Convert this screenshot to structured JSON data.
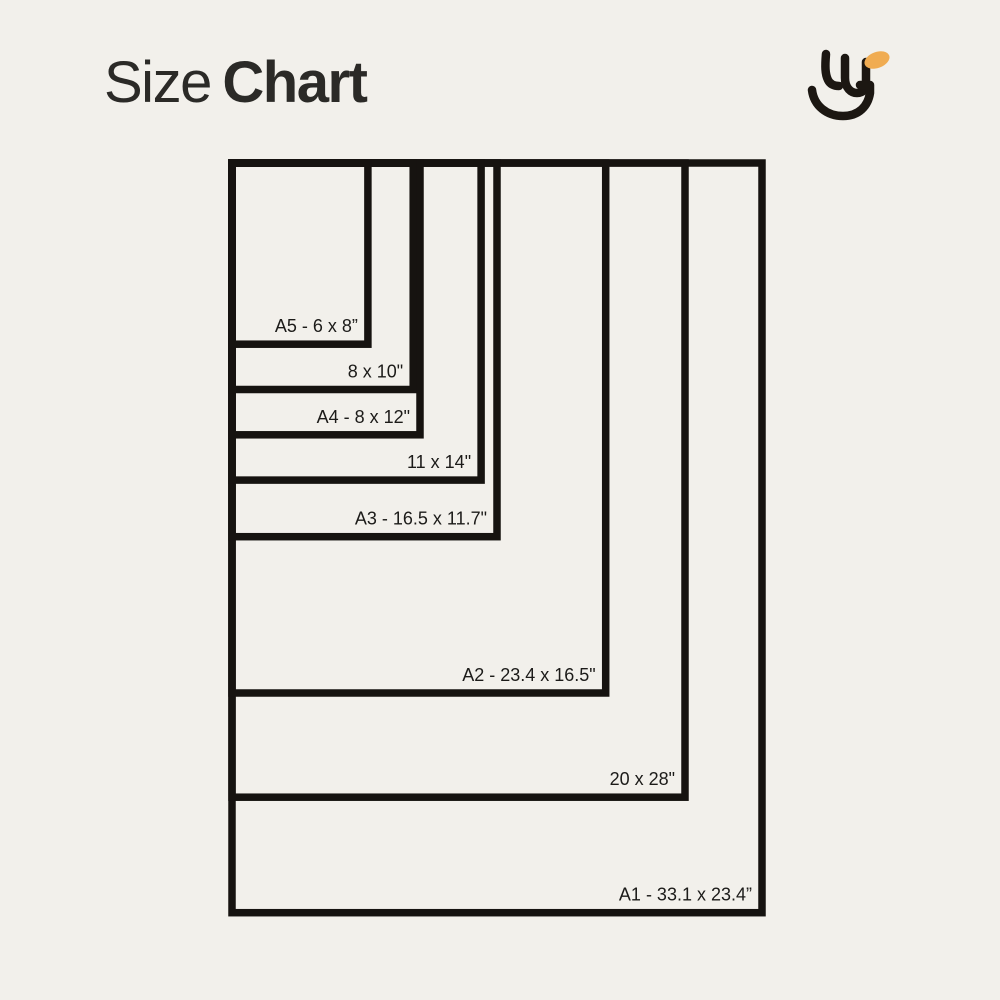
{
  "header": {
    "title_regular": "Size",
    "title_bold": "Chart"
  },
  "logo": {
    "description": "abstract-smile-monogram",
    "ink_color": "#1C1712",
    "accent_color": "#F0AC52"
  },
  "colors": {
    "background": "#F2F0EB",
    "frame": "#161310",
    "label_text": "#1C1B19",
    "title_text": "#2B2A27"
  },
  "chart_data": {
    "type": "nested_rectangles",
    "title": "Size Chart",
    "unit": "inches",
    "orientation": "portrait, all rectangles share top-left corner",
    "scale_px_per_inch": 22.65,
    "origin_px": {
      "x": 232,
      "y": 163
    },
    "frame_stroke_px": 7.5,
    "label_font_px": 18,
    "sizes": [
      {
        "name": "A5",
        "label": "A5 - 6 x 8”",
        "width_in": 6,
        "height_in": 8
      },
      {
        "name": "8x10",
        "label": "8 x 10\"",
        "width_in": 8,
        "height_in": 10
      },
      {
        "name": "A4",
        "label": "A4 - 8 x 12\"",
        "width_in": 8.3,
        "height_in": 12
      },
      {
        "name": "11x14",
        "label": "11 x 14\"",
        "width_in": 11,
        "height_in": 14
      },
      {
        "name": "A3",
        "label": "A3 - 16.5 x 11.7\"",
        "width_in": 11.7,
        "height_in": 16.5
      },
      {
        "name": "A2",
        "label": "A2 - 23.4 x 16.5\"",
        "width_in": 16.5,
        "height_in": 23.4
      },
      {
        "name": "20x28",
        "label": "20 x 28\"",
        "width_in": 20,
        "height_in": 28
      },
      {
        "name": "A1",
        "label": "A1 - 33.1 x 23.4”",
        "width_in": 23.4,
        "height_in": 33.1
      }
    ]
  }
}
